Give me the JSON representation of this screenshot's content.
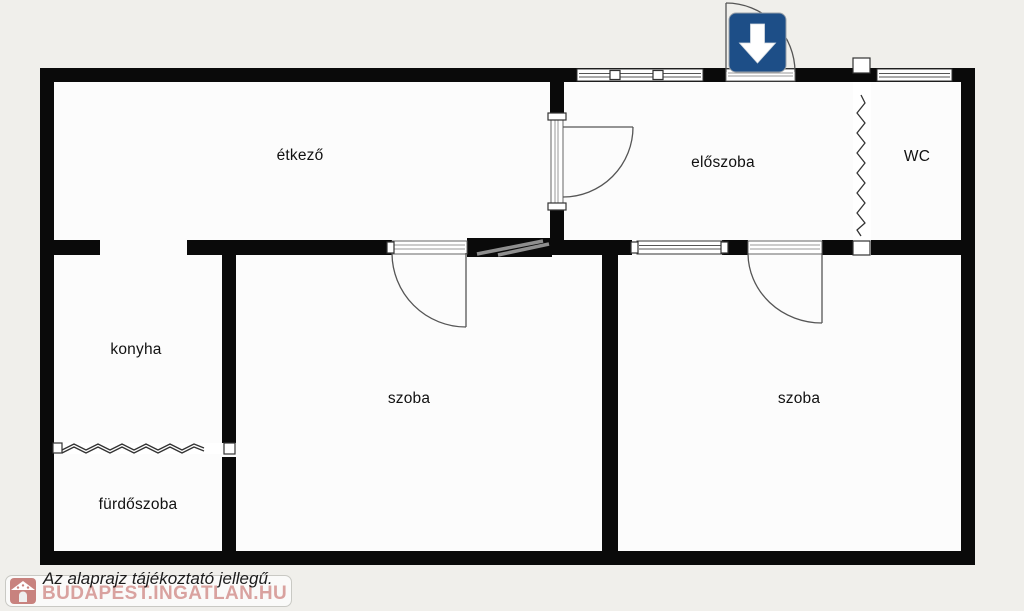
{
  "colors": {
    "page_background": "#f0efeb",
    "paper": "#fcfcfc",
    "wall": "#0a0a0a",
    "entrance_arrow_blue": "#1d4e87",
    "watermark_pink": "#d9a29f",
    "label_text": "#111111"
  },
  "rooms": {
    "etkezo": {
      "label": "étkező"
    },
    "eloszoba": {
      "label": "előszoba"
    },
    "wc": {
      "label": "WC"
    },
    "konyha": {
      "label": "konyha"
    },
    "szoba1": {
      "label": "szoba"
    },
    "szoba2": {
      "label": "szoba"
    },
    "furdoszoba": {
      "label": "fürdőszoba"
    }
  },
  "entrance": {
    "icon": "entrance-down-arrow-icon"
  },
  "footer": {
    "disclaimer": "Az alaprajz tájékoztató jellegű.",
    "watermark_text": "BUDAPEST.INGATLAN.HU",
    "watermark_icon": "house-icon"
  }
}
